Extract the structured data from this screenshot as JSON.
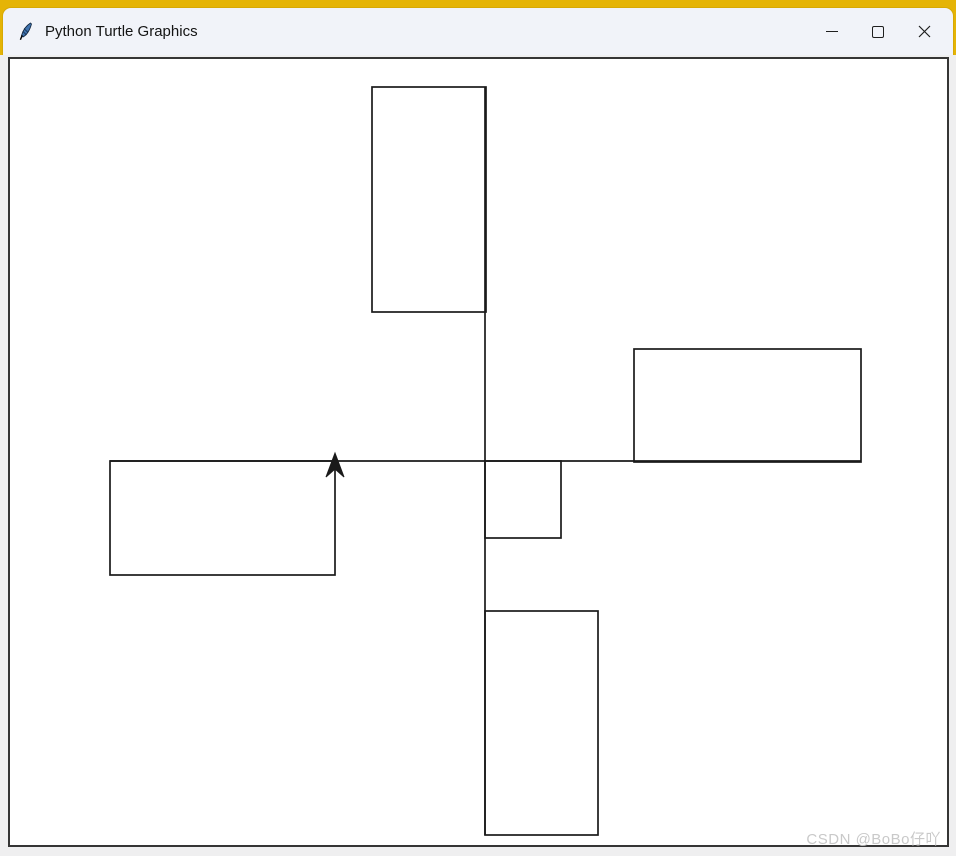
{
  "window": {
    "title": "Python Turtle Graphics",
    "titlebar_icon": "tk-feather-icon",
    "controls": [
      {
        "name": "minimize",
        "icon": "minimize-icon"
      },
      {
        "name": "maximize",
        "icon": "maximize-icon"
      },
      {
        "name": "close",
        "icon": "close-icon"
      }
    ]
  },
  "colors": {
    "backdrop_yellow": "#e5b406",
    "titlebar_bg": "#f1f3f9",
    "window_frame_bg": "#efeff0",
    "canvas_bg": "#ffffff",
    "canvas_border": "#353535",
    "stroke": "#1a1a1a",
    "watermark": "#c9c9c9"
  },
  "drawing": {
    "lines": [
      {
        "name": "horizontal-axis-line",
        "x1": 110,
        "y1": 461,
        "x2": 861,
        "y2": 461
      },
      {
        "name": "vertical-axis-line",
        "x1": 485,
        "y1": 87,
        "x2": 485,
        "y2": 835
      }
    ],
    "rectangles": [
      {
        "name": "rect-top",
        "x": 372,
        "y": 87,
        "w": 114,
        "h": 225
      },
      {
        "name": "rect-right",
        "x": 634,
        "y": 349,
        "w": 227,
        "h": 113
      },
      {
        "name": "rect-left",
        "x": 110,
        "y": 461,
        "w": 225,
        "h": 114
      },
      {
        "name": "rect-center-small",
        "x": 485,
        "y": 461,
        "w": 76,
        "h": 77
      },
      {
        "name": "rect-bottom",
        "x": 485,
        "y": 611,
        "w": 113,
        "h": 224
      }
    ],
    "turtle": {
      "shape": "classic-arrow",
      "x": 335,
      "y": 461,
      "heading_deg": 90
    }
  },
  "watermark": {
    "text": "CSDN @BoBo仔吖"
  }
}
